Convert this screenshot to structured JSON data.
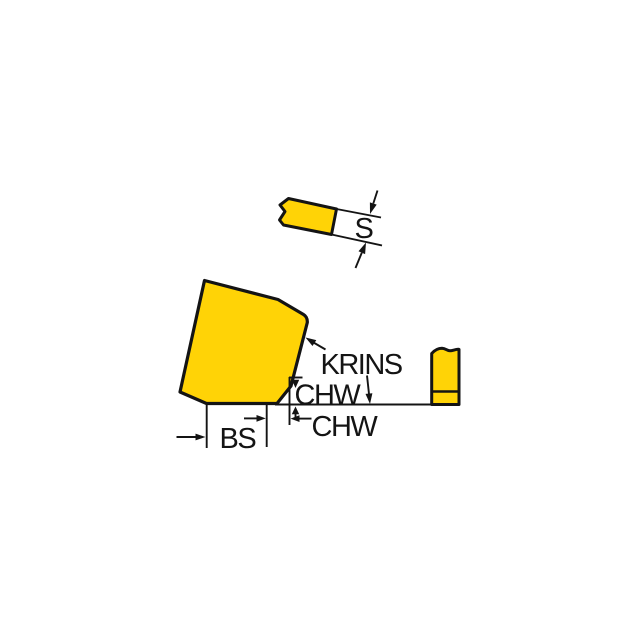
{
  "diagram": {
    "name": "insert-dimension-drawing",
    "colors": {
      "insert_fill": "#FFD306",
      "line": "#141414",
      "background": "#FFFFFF"
    },
    "labels": {
      "thickness": "S",
      "corner_config": "KRINS",
      "chamfer_height": "CHW",
      "chamfer_width": "CHW",
      "seat_length": "BS"
    }
  }
}
